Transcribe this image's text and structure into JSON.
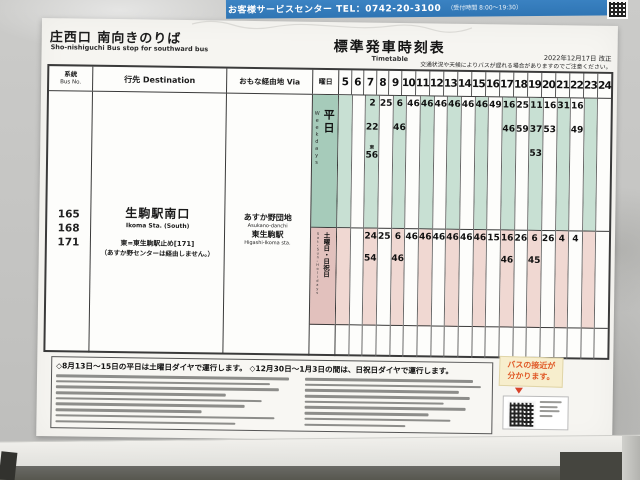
{
  "service_bar": {
    "text": "お客様サービスセンター TEL：0742-20-3100",
    "hours": "（受付時間 8:00～19:30）"
  },
  "stop": {
    "title": "庄西口 南向きのりば",
    "subtitle": "Sho-nishiguchi Bus stop for southward bus"
  },
  "timetable_title": {
    "ja": "標準発車時刻表",
    "en": "Timetable"
  },
  "revision": "2022年12月17日 改正",
  "caution": "交通状況や天候によりバスが遅れる場合がありますのでご注意ください。",
  "columns": {
    "bus_no_ja": "系統",
    "bus_no_en": "Bus No.",
    "destination": "行先 Destination",
    "via": "おもな経由地 Via",
    "day": "曜日"
  },
  "route": {
    "numbers": "165\n168\n171",
    "destination_ja": "生駒駅南口",
    "destination_en": "Ikoma Sta. (South)",
    "note1": "東=東生駒駅止め[171]",
    "note2": "（あすか野センターは経由しません。）",
    "via": [
      {
        "ja": "あすか野団地",
        "en": "Asukano-danchi"
      },
      {
        "ja": "東生駒駅",
        "en": "Higashi-Ikoma sta."
      }
    ]
  },
  "timetable": {
    "hours": [
      "5",
      "6",
      "7",
      "8",
      "9",
      "10",
      "11",
      "12",
      "13",
      "14",
      "15",
      "16",
      "17",
      "18",
      "19",
      "20",
      "21",
      "22",
      "23",
      "24"
    ],
    "sections": [
      {
        "id": "weekday",
        "label": "平日",
        "label_en": "Weekdays",
        "cells": {
          "7": [
            "2",
            "22",
            "東56"
          ],
          "8": [
            "25"
          ],
          "9": [
            "6",
            "46"
          ],
          "10": [
            "46"
          ],
          "11": [
            "46"
          ],
          "12": [
            "46"
          ],
          "13": [
            "46"
          ],
          "14": [
            "46"
          ],
          "15": [
            "46"
          ],
          "16": [
            "49"
          ],
          "17": [
            "16",
            "46"
          ],
          "18": [
            "25",
            "59"
          ],
          "19": [
            "11",
            "37",
            "53"
          ],
          "20": [
            "16",
            "53"
          ],
          "21": [
            "31"
          ],
          "22": [
            "16",
            "49"
          ]
        }
      },
      {
        "id": "holiday",
        "label": "土曜日・日祝日",
        "label_en": "Sat・Sun・Holidays",
        "cells": {
          "7": [
            "24",
            "54"
          ],
          "8": [
            "25"
          ],
          "9": [
            "6",
            "46"
          ],
          "10": [
            "46"
          ],
          "11": [
            "46"
          ],
          "12": [
            "46"
          ],
          "13": [
            "46"
          ],
          "14": [
            "46"
          ],
          "15": [
            "46"
          ],
          "16": [
            "15"
          ],
          "17": [
            "16",
            "46"
          ],
          "18": [
            "26"
          ],
          "19": [
            "6",
            "45"
          ],
          "20": [
            "26"
          ],
          "21": [
            "4"
          ],
          "22": [
            "4"
          ]
        }
      }
    ]
  },
  "footer": {
    "diamond_note": "◇8月13日～15日の平日は土曜日ダイヤで運行します。 ◇12月30日～1月3日の間は、日祝日ダイヤで運行します。"
  },
  "approach": {
    "line1": "バスの接近が",
    "line2": "分かります。"
  },
  "colors": {
    "bar_blue": "#3c84c4",
    "weekday_green": "#a6cbba",
    "weekday_stripe": "#c8e0d3",
    "holiday_pink": "#e2c1bd",
    "holiday_stripe": "#f0d8d2",
    "accent_orange": "#e05a28"
  }
}
